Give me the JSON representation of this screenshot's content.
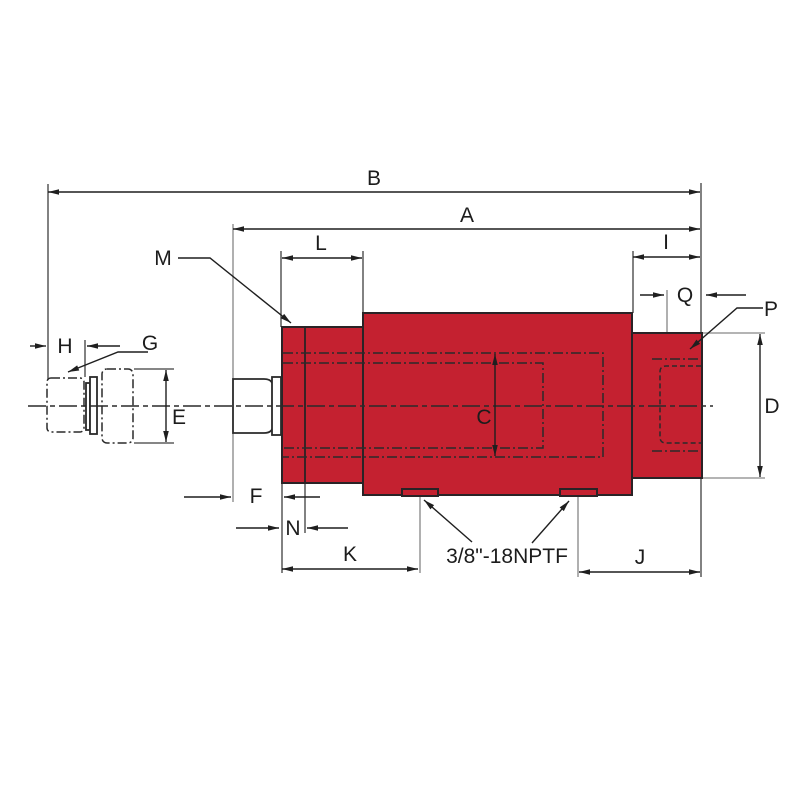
{
  "drawing": {
    "port_thread_label": "3/8\"-18NPTF"
  },
  "dimension_labels": {
    "A": "A",
    "B": "B",
    "C": "C",
    "D": "D",
    "E": "E",
    "F": "F",
    "G": "G",
    "H": "H",
    "I": "I",
    "J": "J",
    "K": "K",
    "L": "L",
    "M": "M",
    "N": "N",
    "P": "P",
    "Q": "Q"
  },
  "colors": {
    "body_fill": "#c42130",
    "outline": "#2a2326",
    "dimension_line": "#1f1f1f",
    "extension_line_gray": "#9c9c9c",
    "background": "#ffffff"
  }
}
